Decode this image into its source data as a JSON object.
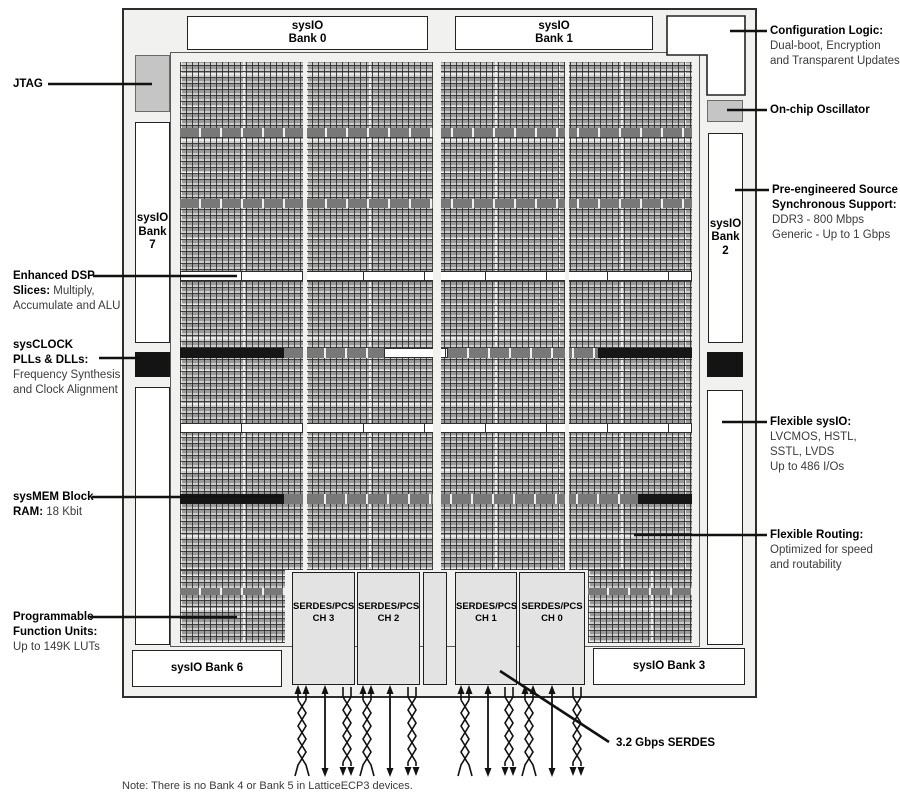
{
  "banks": {
    "bank0": [
      "sysIO",
      "Bank 0"
    ],
    "bank1": [
      "sysIO",
      "Bank 1"
    ],
    "bank7": [
      "sysIO",
      "Bank",
      "7"
    ],
    "bank2": [
      "sysIO",
      "Bank",
      "2"
    ],
    "bank6": "sysIO Bank 6",
    "bank3": "sysIO Bank 3"
  },
  "serdes_channels": [
    {
      "name": "SERDES/PCS",
      "ch": "CH 3"
    },
    {
      "name": "SERDES/PCS",
      "ch": "CH 2"
    },
    {
      "name": "SERDES/PCS",
      "ch": "CH 1"
    },
    {
      "name": "SERDES/PCS",
      "ch": "CH 0"
    }
  ],
  "callouts": {
    "jtag": {
      "title": "JTAG"
    },
    "config_logic": {
      "title": "Configuration Logic:",
      "lines": [
        "Dual-boot, Encryption",
        "and Transparent Updates"
      ]
    },
    "oscillator": {
      "title": "On-chip Oscillator"
    },
    "source_sync": {
      "title1": "Pre-engineered Source",
      "title2": "Synchronous Support:",
      "lines": [
        "DDR3 - 800 Mbps",
        "Generic - Up to 1 Gbps"
      ]
    },
    "flexible_sysio": {
      "title": "Flexible sysIO:",
      "lines": [
        "LVCMOS, HSTL,",
        "SSTL, LVDS",
        "Up to 486 I/Os"
      ]
    },
    "flexible_routing": {
      "title": "Flexible Routing:",
      "lines": [
        "Optimized for speed",
        "and routability"
      ]
    },
    "dsp": {
      "title1": "Enhanced DSP",
      "bold2": "Slices:",
      "rest2": " Multiply,",
      "line3": "Accumulate and ALU"
    },
    "clock": {
      "title1": "sysCLOCK",
      "title2": "PLLs & DLLs:",
      "lines": [
        "Frequency Synthesis",
        "and Clock Alignment"
      ]
    },
    "mem": {
      "title1": "sysMEM Block",
      "bold2": "RAM:",
      "rest2": " 18 Kbit"
    },
    "pfu": {
      "title1": "Programmable",
      "title2": "Function Units:",
      "line3": "Up to 149K LUTs"
    },
    "serdes_speed": {
      "title": "3.2 Gbps SERDES"
    }
  },
  "note": "Note: There is no Bank 4 or Bank 5 in LatticeECP3 devices.",
  "colors": {
    "chip_fill": "#f1f1f0",
    "fabric_gray": "#b2b2b2",
    "block_black": "#141414",
    "io_block_gray": "#c5c5c5",
    "serdes_fill": "#e3e3e3",
    "line_black": "#111111"
  }
}
